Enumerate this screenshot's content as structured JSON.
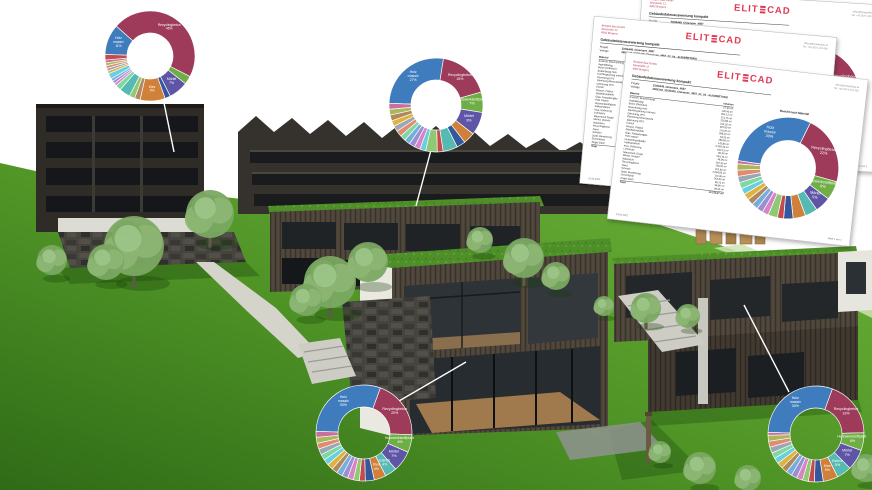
{
  "logo": {
    "left": "ELIT",
    "right": "CAD"
  },
  "documents": {
    "report": {
      "company_lines": [
        "Beispiel Bau GmbH",
        "Seestraße 12",
        "6900 Bregenz"
      ],
      "contact_lines": [
        "office@beispielbau.at",
        "Tel. +43 5574 123 456"
      ],
      "title": "Gebäudedatenauswertung kompakt",
      "meta": [
        {
          "label": "Projekt",
          "value": "22/26448_Chiemsee_4857"
        },
        {
          "label": "Vorlage",
          "value": "2656142_22/26448_Chiemsee_4857_02_04 - AUSWERTUNG"
        }
      ],
      "chart_title": "Bericht nach Material",
      "table": {
        "headers": [
          "Material",
          "Volumen"
        ],
        "rows": [
          [
            "Anstrich, Beschichtung",
            "57,90 m³"
          ],
          [
            "Asphaltbelag",
            "128,40 m³"
          ],
          [
            "Beton (Ortbeton)",
            "954,12 m³"
          ],
          [
            "Bodenbelag Holz",
            "214,75 m³"
          ],
          [
            "Dachbegrünung extensiv",
            "325,80 m³"
          ],
          [
            "Dämmung EPS",
            "412,30 m³"
          ],
          [
            "Dämmung Mineralwolle",
            "387,60 m³"
          ],
          [
            "Dämmung XPS",
            "176,25 m³"
          ],
          [
            "Estrich",
            "498,10 m³"
          ],
          [
            "Fliesen, Platten",
            "64,20 m³"
          ],
          [
            "Gipskartonplatte",
            "188,50 m³"
          ],
          [
            "Glas, Fassadenglas",
            "142,85 m³"
          ],
          [
            "Holz massiv",
            "3.265,40 m³"
          ],
          [
            "Holzwerkstoffplatte",
            "642,15 m³"
          ],
          [
            "Kalksandstein",
            "96,30 m³"
          ],
          [
            "Kies, Rollierung",
            "534,70 m³"
          ],
          [
            "Lehmputz",
            "48,95 m³"
          ],
          [
            "Mauerwerk Ziegel",
            "287,45 m³"
          ],
          [
            "Mörtel, Verputz",
            "758,20 m³"
          ],
          [
            "Naturstein",
            "325,60 m³"
          ],
          [
            "Recyclingbeton",
            "2.094,85 m³"
          ],
          [
            "Sand",
            "112,40 m³"
          ],
          [
            "Schotter",
            "264,30 m³"
          ],
          [
            "Stahl, Bewehrung",
            "38,75 m³"
          ],
          [
            "Zementputz",
            "96,80 m³"
          ],
          [
            "Ziegel Dach",
            "96,45 m³"
          ]
        ],
        "total_label": "Total",
        "total_value": "12.212,27 m³"
      },
      "footer_left": "01.04.2022",
      "footer_right": "Seite 1 von 1"
    }
  },
  "chart_data": {
    "top_left": {
      "type": "donut",
      "title": "",
      "unit": "%",
      "segments": [
        {
          "label": "Holz massiv",
          "value": 11,
          "color": "#3e7cbe"
        },
        {
          "label": "Recyclingbeton",
          "value": 46,
          "color": "#9e3a5a"
        },
        {
          "label": "Holzwerkstoffplatte",
          "value": 3,
          "color": "#6fae45"
        },
        {
          "label": "Mörtel",
          "value": 7,
          "color": "#5f55a7"
        },
        {
          "label": "Beton",
          "value": 2,
          "color": "#33589e"
        },
        {
          "label": "Kies",
          "value": 9,
          "color": "#d08038"
        },
        {
          "label": "Naturstein",
          "value": 2,
          "color": "#b0895e"
        },
        {
          "label": "Dämmung",
          "value": 2,
          "color": "#8fc973"
        },
        {
          "label": "Estrich",
          "value": 4,
          "color": "#56bab2"
        },
        {
          "label": "Sand",
          "value": 2,
          "color": "#7fd8a0"
        },
        {
          "label": "Dachbegrünung",
          "value": 1,
          "color": "#d684c5"
        },
        {
          "label": "Gipskarton",
          "value": 1,
          "color": "#9a8fd2"
        },
        {
          "label": "Glas",
          "value": 1,
          "color": "#74aede"
        },
        {
          "label": "Putz",
          "value": 2,
          "color": "#67cfe0"
        },
        {
          "label": "Ziegel",
          "value": 1,
          "color": "#e0b23e"
        },
        {
          "label": "Stahl",
          "value": 1,
          "color": "#9aa7b5"
        },
        {
          "label": "Schotter",
          "value": 1,
          "color": "#e08c6e"
        },
        {
          "label": "Lehm",
          "value": 1,
          "color": "#a9b85a"
        },
        {
          "label": "Fliesen",
          "value": 1,
          "color": "#c96f9d"
        },
        {
          "label": "Anstrich",
          "value": 2,
          "color": "#c44b4b"
        }
      ]
    },
    "middle": {
      "type": "donut",
      "title": "",
      "unit": "%",
      "segments": [
        {
          "label": "Holz massiv",
          "value": 27,
          "color": "#3e7cbe"
        },
        {
          "label": "Recyclingbeton",
          "value": 18,
          "color": "#9e3a5a"
        },
        {
          "label": "Holzwerkstoffplatte",
          "value": 7,
          "color": "#6fae45"
        },
        {
          "label": "Mörtel",
          "value": 8,
          "color": "#5f55a7"
        },
        {
          "label": "Kies",
          "value": 4,
          "color": "#d08038"
        },
        {
          "label": "Beton",
          "value": 3,
          "color": "#33589e"
        },
        {
          "label": "Estrich",
          "value": 5,
          "color": "#56bab2"
        },
        {
          "label": "Anstrich",
          "value": 2,
          "color": "#c44b4b"
        },
        {
          "label": "Dämmung",
          "value": 4,
          "color": "#8fc973"
        },
        {
          "label": "Putz",
          "value": 2,
          "color": "#67cfe0"
        },
        {
          "label": "Dachbegrünung",
          "value": 2,
          "color": "#d684c5"
        },
        {
          "label": "Gipskarton",
          "value": 2,
          "color": "#9a8fd2"
        },
        {
          "label": "Glas",
          "value": 2,
          "color": "#74aede"
        },
        {
          "label": "Sand",
          "value": 2,
          "color": "#7fd8a0"
        },
        {
          "label": "Schotter",
          "value": 2,
          "color": "#e08c6e"
        },
        {
          "label": "Stahl",
          "value": 2,
          "color": "#9aa7b5"
        },
        {
          "label": "Ziegel",
          "value": 2,
          "color": "#e0b23e"
        },
        {
          "label": "Naturstein",
          "value": 2,
          "color": "#b0895e"
        },
        {
          "label": "Lehm",
          "value": 2,
          "color": "#a9b85a"
        },
        {
          "label": "Fliesen",
          "value": 2,
          "color": "#c96f9d"
        }
      ]
    },
    "bottom_left": {
      "type": "donut",
      "title": "",
      "unit": "%",
      "segments": [
        {
          "label": "Holz massiv",
          "value": 30,
          "color": "#3e7cbe"
        },
        {
          "label": "Recyclingbeton",
          "value": 20,
          "color": "#9e3a5a"
        },
        {
          "label": "Holzwerkstoffplatte",
          "value": 6,
          "color": "#6fae45"
        },
        {
          "label": "Mörtel",
          "value": 7,
          "color": "#5f55a7"
        },
        {
          "label": "Estrich",
          "value": 4,
          "color": "#56bab2"
        },
        {
          "label": "Kies",
          "value": 4,
          "color": "#d08038"
        },
        {
          "label": "Beton",
          "value": 3,
          "color": "#33589e"
        },
        {
          "label": "Anstrich",
          "value": 2,
          "color": "#c44b4b"
        },
        {
          "label": "Dämmung",
          "value": 2,
          "color": "#8fc973"
        },
        {
          "label": "Dachbegrünung",
          "value": 2,
          "color": "#d684c5"
        },
        {
          "label": "Gipskarton",
          "value": 2,
          "color": "#9a8fd2"
        },
        {
          "label": "Glas",
          "value": 2,
          "color": "#74aede"
        },
        {
          "label": "Naturstein",
          "value": 2,
          "color": "#b0895e"
        },
        {
          "label": "Ziegel",
          "value": 2,
          "color": "#e0b23e"
        },
        {
          "label": "Putz",
          "value": 2,
          "color": "#67cfe0"
        },
        {
          "label": "Sand",
          "value": 2,
          "color": "#7fd8a0"
        },
        {
          "label": "Stahl",
          "value": 2,
          "color": "#9aa7b5"
        },
        {
          "label": "Schotter",
          "value": 2,
          "color": "#e08c6e"
        },
        {
          "label": "Lehm",
          "value": 2,
          "color": "#a9b85a"
        },
        {
          "label": "Fliesen",
          "value": 2,
          "color": "#c96f9d"
        }
      ]
    },
    "bottom_right": {
      "type": "donut",
      "title": "",
      "unit": "%",
      "segments": [
        {
          "label": "Holz massiv",
          "value": 30,
          "color": "#3e7cbe"
        },
        {
          "label": "Recyclingbeton",
          "value": 19,
          "color": "#9e3a5a"
        },
        {
          "label": "Holzwerkstoffplatte",
          "value": 6,
          "color": "#6fae45"
        },
        {
          "label": "Mörtel",
          "value": 7,
          "color": "#5f55a7"
        },
        {
          "label": "Estrich",
          "value": 5,
          "color": "#56bab2"
        },
        {
          "label": "Kies",
          "value": 5,
          "color": "#d08038"
        },
        {
          "label": "Beton",
          "value": 3,
          "color": "#33589e"
        },
        {
          "label": "Anstrich",
          "value": 2,
          "color": "#c44b4b"
        },
        {
          "label": "Dämmung",
          "value": 2,
          "color": "#8fc973"
        },
        {
          "label": "Dachbegrünung",
          "value": 2,
          "color": "#d684c5"
        },
        {
          "label": "Gipskarton",
          "value": 2,
          "color": "#9a8fd2"
        },
        {
          "label": "Glas",
          "value": 2,
          "color": "#74aede"
        },
        {
          "label": "Naturstein",
          "value": 2,
          "color": "#b0895e"
        },
        {
          "label": "Ziegel",
          "value": 2,
          "color": "#e0b23e"
        },
        {
          "label": "Putz",
          "value": 2,
          "color": "#67cfe0"
        },
        {
          "label": "Sand",
          "value": 2,
          "color": "#7fd8a0"
        },
        {
          "label": "Stahl",
          "value": 2,
          "color": "#9aa7b5"
        },
        {
          "label": "Schotter",
          "value": 2,
          "color": "#e08c6e"
        },
        {
          "label": "Lehm",
          "value": 2,
          "color": "#a9b85a"
        },
        {
          "label": "Fliesen",
          "value": 1,
          "color": "#c96f9d"
        }
      ]
    },
    "document": {
      "type": "donut",
      "title": "Bericht nach Material",
      "unit": "%",
      "segments": [
        {
          "label": "Holz massiv",
          "value": 30,
          "color": "#3e7cbe"
        },
        {
          "label": "Recyclingbeton",
          "value": 22,
          "color": "#9e3a5a"
        },
        {
          "label": "Holzwerkstoffplatte",
          "value": 6,
          "color": "#6fae45"
        },
        {
          "label": "Mörtel",
          "value": 5,
          "color": "#5f55a7"
        },
        {
          "label": "Estrich",
          "value": 4,
          "color": "#56bab2"
        },
        {
          "label": "Kies",
          "value": 4,
          "color": "#d08038"
        },
        {
          "label": "Beton",
          "value": 3,
          "color": "#33589e"
        },
        {
          "label": "Anstrich",
          "value": 2,
          "color": "#c44b4b"
        },
        {
          "label": "Dämmung",
          "value": 3,
          "color": "#8fc973"
        },
        {
          "label": "Dachbegrünung",
          "value": 2,
          "color": "#d684c5"
        },
        {
          "label": "Gipskarton",
          "value": 2,
          "color": "#9a8fd2"
        },
        {
          "label": "Glas",
          "value": 2,
          "color": "#74aede"
        },
        {
          "label": "Naturstein",
          "value": 2,
          "color": "#b0895e"
        },
        {
          "label": "Ziegel",
          "value": 2,
          "color": "#e0b23e"
        },
        {
          "label": "Putz",
          "value": 2,
          "color": "#67cfe0"
        },
        {
          "label": "Sand",
          "value": 2,
          "color": "#7fd8a0"
        },
        {
          "label": "Stahl",
          "value": 2,
          "color": "#9aa7b5"
        },
        {
          "label": "Schotter",
          "value": 2,
          "color": "#e08c6e"
        },
        {
          "label": "Lehm",
          "value": 2,
          "color": "#a9b85a"
        },
        {
          "label": "Fliesen",
          "value": 1,
          "color": "#c96f9d"
        }
      ]
    }
  }
}
